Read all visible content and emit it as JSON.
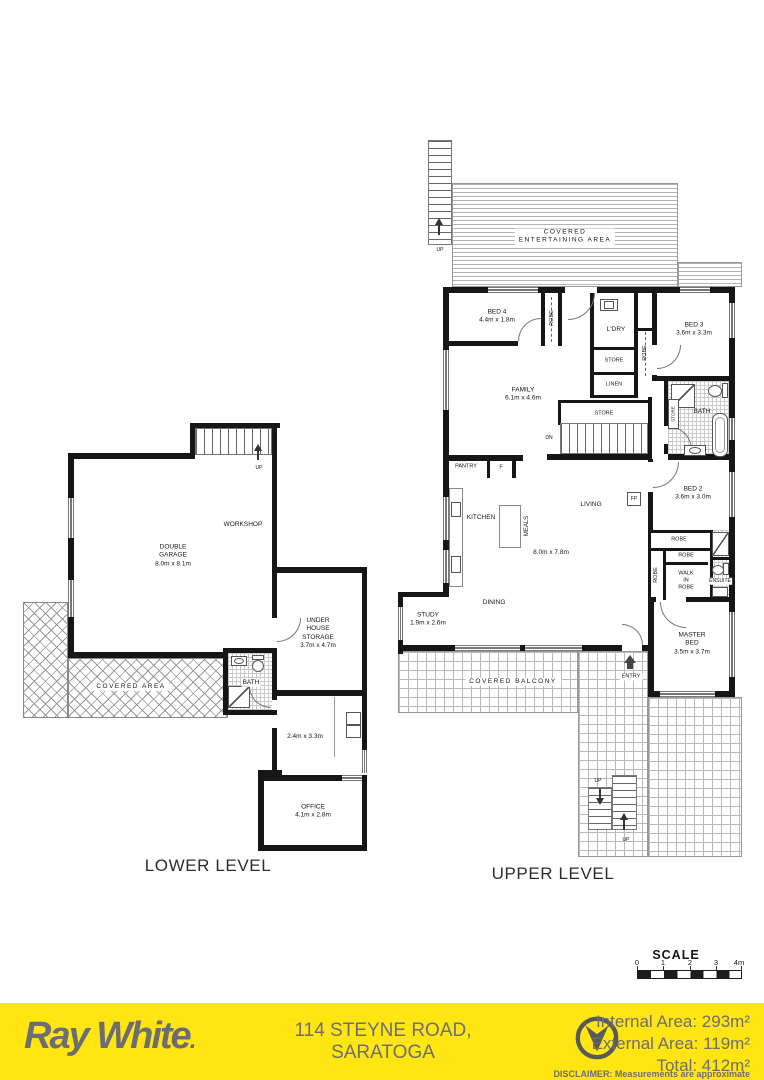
{
  "labels": {
    "up": "UP",
    "dn": "DN",
    "robe": "ROBE",
    "store": "STORE",
    "linen": "LINEN",
    "bath": "BATH",
    "pantry": "PANTRY",
    "fridge": "F",
    "fp": "FP",
    "entry": "ENTRY",
    "ensuite": "ENSUITE"
  },
  "upper": {
    "level_label": "UPPER LEVEL",
    "covered_entertaining": "COVERED\nENTERTAINING AREA",
    "bed4": "BED 4\n4.4m x 1.8m",
    "ldry": "L'DRY",
    "bed3": "BED 3\n3.6m x 3.3m",
    "family": "FAMILY\n6.1m x 4.6m",
    "kitchen": "KITCHEN",
    "meals": "MEALS",
    "living": "LIVING",
    "living_dims": "8.0m x 7.8m",
    "bed2": "BED 2\n3.6m x 3.0m",
    "wir": "WALK\nIN\nROBE",
    "master": "MASTER\nBED\n3.5m x 3.7m",
    "dining": "DINING",
    "study": "STUDY\n1.9m x 2.6m",
    "covered_balcony": "COVERED BALCONY"
  },
  "lower": {
    "level_label": "LOWER LEVEL",
    "workshop": "WORKSHOP",
    "garage": "DOUBLE\nGARAGE\n8.0m x 8.1m",
    "uhs": "UNDER\nHOUSE\nSTORAGE\n3.7m x 4.7m",
    "covered_area": "COVERED AREA",
    "room_2433": "2.4m x 3.3m",
    "office": "OFFICE\n4.1m x 2.8m"
  },
  "scale": {
    "title": "SCALE",
    "ticks": [
      "0",
      "1",
      "2",
      "3",
      "4m"
    ]
  },
  "footer": {
    "brand": "Ray White",
    "brand_dot": ".",
    "address_line1": "114 STEYNE ROAD,",
    "address_line2": "SARATOGA",
    "internal": "Internal Area: 293m²",
    "external": "External Area: 119m²",
    "total": "Total: 412m²",
    "disclaimer": "DISCLAIMER: Measurements are approximate",
    "brand_color": "#6d6e71",
    "bar_color": "#FFE512"
  }
}
